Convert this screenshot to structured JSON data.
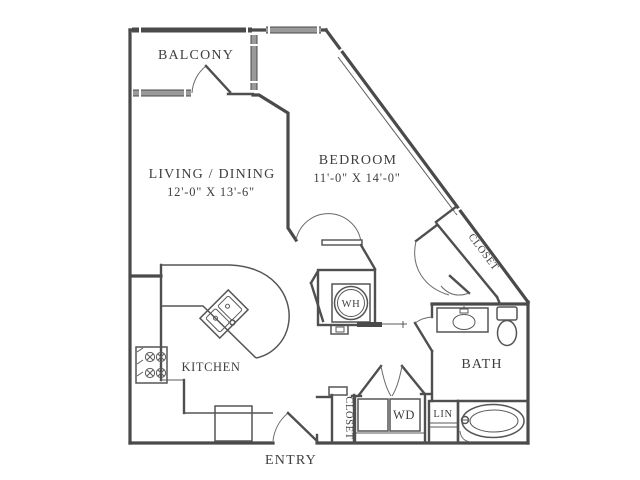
{
  "document": {
    "type": "apartment-floor-plan"
  },
  "rooms": {
    "balcony": {
      "label": "BALCONY"
    },
    "living_dining": {
      "label": "LIVING / DINING",
      "dimensions": "12'-0\" X 13'-6\""
    },
    "bedroom": {
      "label": "BEDROOM",
      "dimensions": "11'-0\" X 14'-0\""
    },
    "kitchen": {
      "label": "KITCHEN"
    },
    "bath": {
      "label": "BATH"
    },
    "entry": {
      "label": "ENTRY"
    }
  },
  "storage": {
    "bedroom_closet": {
      "label": "CLOSET"
    },
    "entry_closet": {
      "label": "CLOSET"
    },
    "linen_closet": {
      "label": "LIN"
    }
  },
  "equipment": {
    "washer_dryer": {
      "label": "WD"
    },
    "water_heater": {
      "label": "WH"
    }
  },
  "colors": {
    "wall": "#4a4a4a",
    "window": "#9a9a9a",
    "text": "#3f3f3f",
    "background": "#ffffff"
  }
}
